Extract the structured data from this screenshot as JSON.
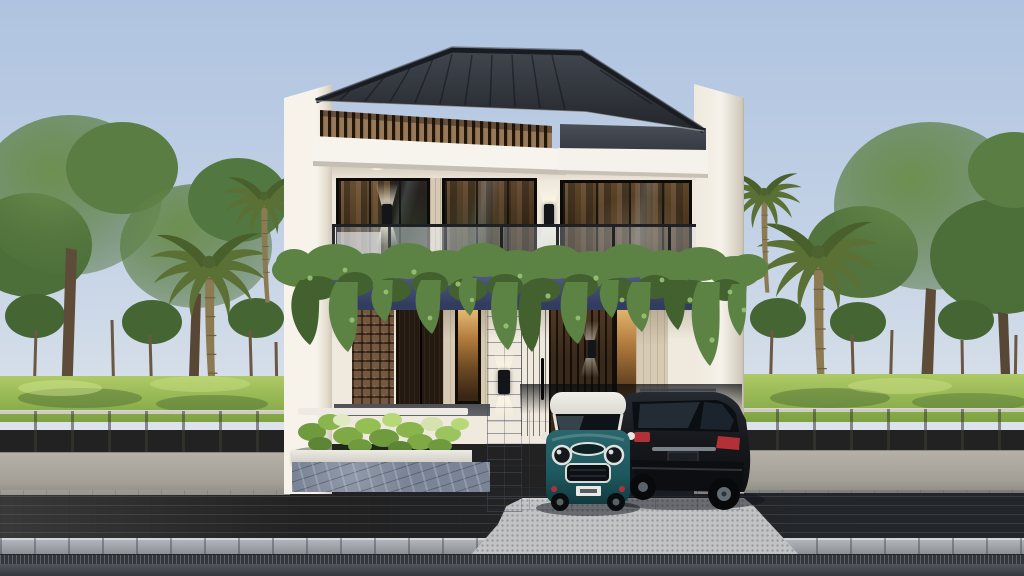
{
  "scene": {
    "title": "Modern two-story tropical house — exterior 3D rendering, street view at dusk",
    "setting": "residential street with concrete boundary fence, paver sidewalk and asphalt road",
    "house": {
      "stories": 2,
      "style": "modern tropical minimalist",
      "roof": "dark charcoal hip roof with timber louver band beneath",
      "facade": [
        "white parapet side walls",
        "glass balcony railing",
        "hanging vine curtain under balcony",
        "navy balcony fascia"
      ],
      "second_floor": [
        "three dark-framed glass door units with brown curtains",
        "two up/down wall sconces",
        "three recessed ceiling downlights"
      ],
      "ground_floor": [
        "brown breeze-block decorative panel",
        "dark timber double door",
        "warm-lit slit windows",
        "stone-tile clad pillar with sconce",
        "dark timber entry door",
        "timber slat carport wall",
        "travertine trims",
        "white planter box with shrubs",
        "flagstone base",
        "carport with concrete tile floor",
        "driveway ramp"
      ]
    },
    "vehicles": [
      {
        "type": "compact hatchback (Mini-style)",
        "body_color_ref": "car-teal",
        "roof": "white",
        "view": "front",
        "license_plate": {
          "visible": true,
          "legible": false
        }
      },
      {
        "type": "SUV",
        "body_color_ref": "suv-black",
        "view": "rear three-quarter",
        "details": [
          "red taillights",
          "chrome strip",
          "roof rails"
        ]
      }
    ],
    "vegetation": [
      "broadleaf canopy trees",
      "palm trees",
      "lawn with tree trunks",
      "hanging vines",
      "planter shrubs",
      "small weeds at fence base"
    ],
    "street_elements": [
      "precast concrete fence with vertical joints",
      "concrete fence base",
      "gray paver sidewalk",
      "light curb stones",
      "steel drainage grate strip",
      "dark asphalt road"
    ]
  },
  "palette": {
    "sky-top": "#afc3e0",
    "sky-bottom": "#dce3ea",
    "roof-dark": "#3a3f48",
    "roof-deep": "#23262b",
    "fascia-white": "#f7f4ed",
    "wall-cream": "#f0e9dd",
    "louver-wood": "#97795a",
    "glass-dark": "#191410",
    "curtain-brown": "#70502f",
    "navy-band": "#4d5a85",
    "vine-mid": "#5c8344",
    "vine-dark": "#42612f",
    "vine-light": "#9cc178",
    "grass-light": "#aeca66",
    "grass-dark": "#7da241",
    "tree-green": "#55763c",
    "fence-light": "#b2aea6",
    "fence-base": "#b5b1a9",
    "pave-light": "#a4a9b1",
    "pave-dark": "#7e8a9c",
    "curb-gray": "#b1b4b9",
    "drain-dark": "#33363b",
    "street-dark": "#51565d",
    "ramp-gray": "#c2c3c4",
    "pillar-stone": "#b2bac7",
    "travertine": "#d6cab5",
    "roster-brown": "#745840",
    "door-brown": "#241a11",
    "slat-brown": "#39291b",
    "flagstone": "#7b8496",
    "planter-white": "#eceae3",
    "carport-gray": "#a6adb9",
    "car-teal": "#1d585e",
    "car-roof-white": "#eceae6",
    "suv-black": "#16181c",
    "taillight-red": "#b23038"
  }
}
